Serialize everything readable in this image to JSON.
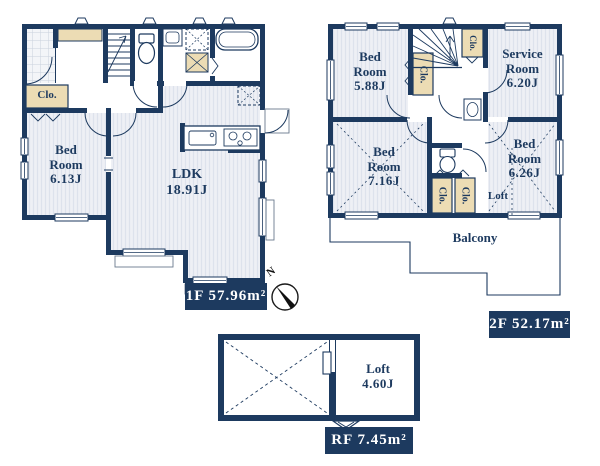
{
  "floor1": {
    "area_label": "1F 57.96m²",
    "bedroom": {
      "l1": "Bed",
      "l2": "Room",
      "size": "6.13J"
    },
    "ldk": {
      "l1": "LDK",
      "size": "18.91J"
    },
    "closet": "Clo."
  },
  "floor2": {
    "area_label": "2F 52.17m²",
    "bedroom1": {
      "l1": "Bed",
      "l2": "Room",
      "size": "5.88J"
    },
    "service_room": {
      "l1": "Service",
      "l2": "Room",
      "size": "6.20J"
    },
    "bedroom2": {
      "l1": "Bed",
      "l2": "Room",
      "size": "7.16J"
    },
    "bedroom3": {
      "l1": "Bed",
      "l2": "Room",
      "size": "6.26J"
    },
    "closet1": "Clo.",
    "closet2": "Clo.",
    "closet3": "Clo.",
    "closet4": "Clo.",
    "loft": "Loft",
    "balcony": "Balcony"
  },
  "roof": {
    "area_label": "RF 7.45m²",
    "loft": {
      "l1": "Loft",
      "size": "4.60J"
    }
  },
  "compass": {
    "north": "N"
  },
  "colors": {
    "wall": "#1d3a5f",
    "closet_fill": "#ecdcb4",
    "floor_fill": "#eef0f5",
    "label_bg": "#1d3a5f",
    "label_text": "#ffffff"
  }
}
